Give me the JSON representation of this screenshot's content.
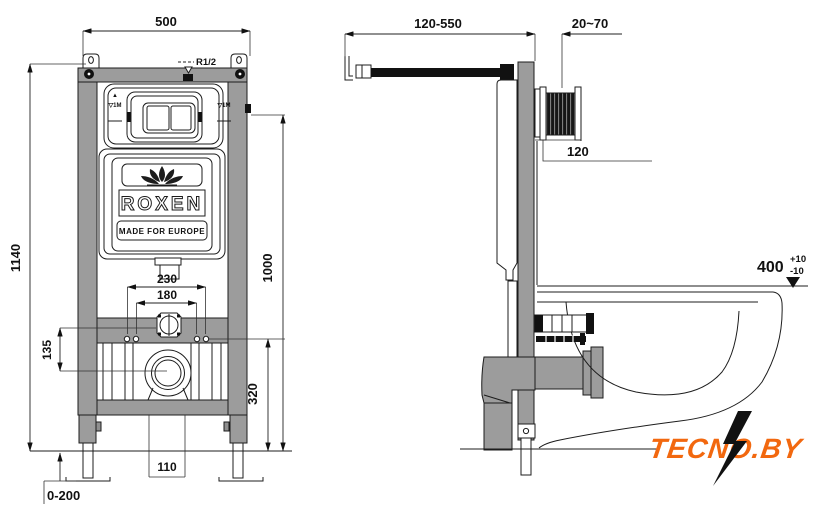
{
  "front_view": {
    "dim_frame_width": "500",
    "dim_frame_height": "1140",
    "label_inlet_thread": "R1/2",
    "mark_up_arrow": "▲",
    "mark_meter_left": "▽1M",
    "mark_meter_right": "▽1M",
    "dim_fixing_outer": "230",
    "dim_fixing_inner": "180",
    "dim_meter_mark_height": "1000",
    "dim_inlet_to_outlet": "135",
    "dim_fixing_height": "320",
    "dim_outlet_gap": "110",
    "dim_feet_adjust": "0-200",
    "cistern": {
      "brand": "ROXEN",
      "subtitle": "MADE FOR EUROPE"
    }
  },
  "side_view": {
    "dim_bracket_depth": "120-550",
    "dim_wall_offset": "20~70",
    "dim_plate_height": "120",
    "dim_bowl_height": "400",
    "dim_bowl_tol_plus": "+10",
    "dim_bowl_tol_minus": "-10"
  },
  "watermark": {
    "text": "TECNO.BY",
    "color": "#f2680f"
  },
  "colors": {
    "frame_gray": "#9c9c9c",
    "outline": "#1c1c1c"
  }
}
